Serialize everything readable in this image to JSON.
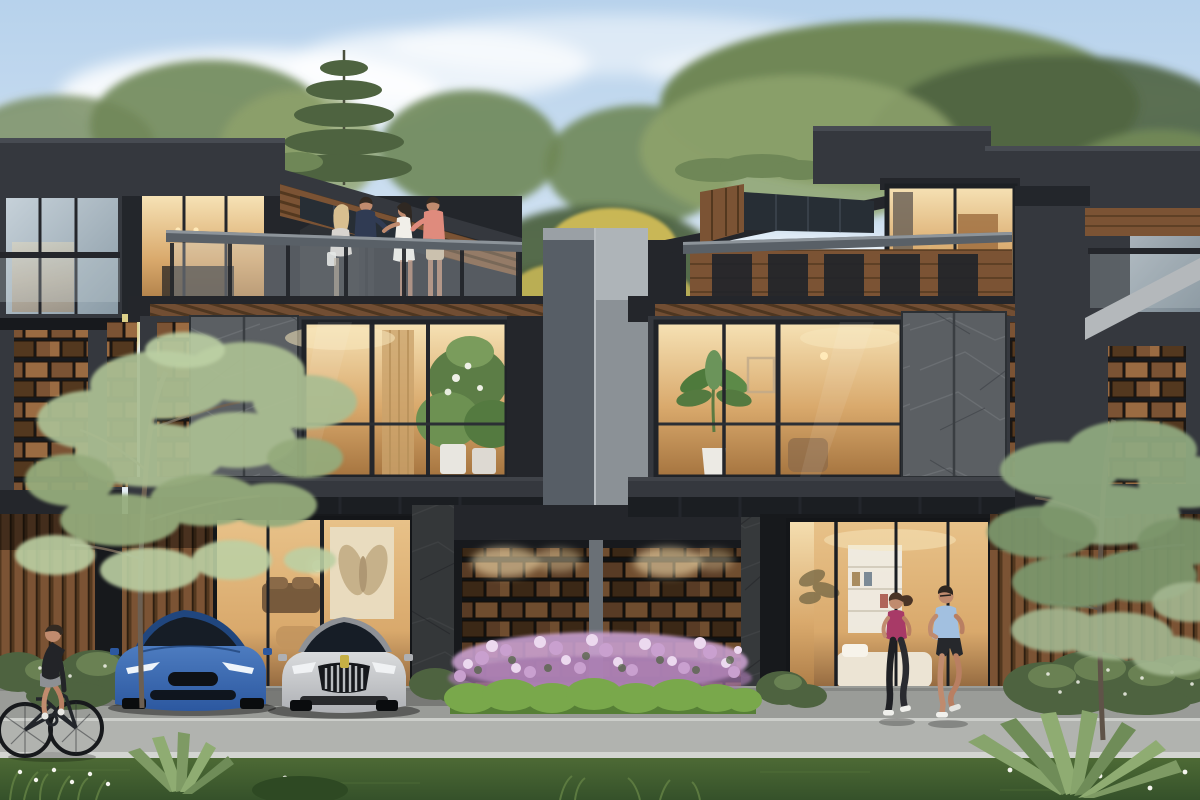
{
  "scene": {
    "setting": "dusk architectural rendering of a row of modern dark-clad townhouses",
    "objects": [
      "sky",
      "clouds",
      "background-trees",
      "yellow-flowering-trees",
      "roof-hedge",
      "left-neighbor-unit",
      "left-townhouse",
      "right-townhouse",
      "right-neighbor-unit",
      "center-divider-wall",
      "rooftop-terrace",
      "glass-balustrade",
      "canopy-skylight",
      "stone-cladding-panel",
      "timber-block-feature-wall",
      "timber-slat-wall",
      "lit-interior-window",
      "winged-artwork",
      "indoor-plants",
      "palm-plant",
      "bookshelf",
      "bed",
      "blue-sedan",
      "silver-sedan",
      "cyclist",
      "jogger-woman",
      "jogger-man",
      "terrace-people",
      "flower-hedge",
      "boxwood-hedge",
      "shrub-bed",
      "ornamental-tree",
      "agave-plant",
      "forecourt",
      "sidewalk",
      "lawn"
    ]
  },
  "palette": {
    "sky_top": "#b7d2ec",
    "sky_mid": "#d8e6f3",
    "sky_low": "#edf2f6",
    "cloud": "#ffffff",
    "tree_dark": "#4e6340",
    "tree_mid": "#6f8757",
    "tree_light": "#8ea36c",
    "tree_sage": "#aabd92",
    "tree_yellow": "#d6c058",
    "facade": "#35383e",
    "facade_dark": "#24262b",
    "facade_light": "#474b52",
    "shadow": "#17191d",
    "wood": "#7b5334",
    "wood_light": "#9a6b42",
    "wood_dark": "#53381f",
    "stone": "#5b5f63",
    "stone_light": "#777b7f",
    "stone_dark": "#3f4347",
    "glass_hi": "#c6d1d9",
    "glass_lo": "#8a9ba6",
    "rail_glass": "#cdd8dd",
    "warm_hi": "#f6e2b5",
    "warm_mid": "#d9a96c",
    "warm_lo": "#a5743f",
    "wall_hi": "#aeb4b8",
    "wall_lo": "#8b9196",
    "wall_dk": "#575e66",
    "lawn_hi": "#4d6a35",
    "lawn_lo": "#35512a",
    "hedge": "#79a84b",
    "hedge_dark": "#567f36",
    "flower_hi": "#ecd9ef",
    "flower": "#c9a0cf",
    "flower_lo": "#a376ab",
    "court": "#9a9c98",
    "road": "#b1b3af",
    "curb": "#d3d5d1",
    "car_blue_hi": "#4d7cc0",
    "car_blue": "#2c58a0",
    "car_silver_hi": "#d9dbdd",
    "car_silver": "#aeb0b4",
    "car_glass": "#161d26",
    "chrome": "#cbced1",
    "badge": "#c6b045",
    "skin": "#c08b6e",
    "hair_dark": "#332a22",
    "hair_blonde": "#d8bf90",
    "navy": "#303b53",
    "coral": "#df8b7d",
    "white_dress": "#f1efe9",
    "black_cloth": "#232428",
    "gray_shorts": "#8d9094",
    "magenta": "#a83a67",
    "lt_blue": "#a2c0e0",
    "trunk": "#6c5f52",
    "art_beige": "#e9ddc2",
    "art_wing": "#c3ad85",
    "glow": "#ffe9b8"
  }
}
